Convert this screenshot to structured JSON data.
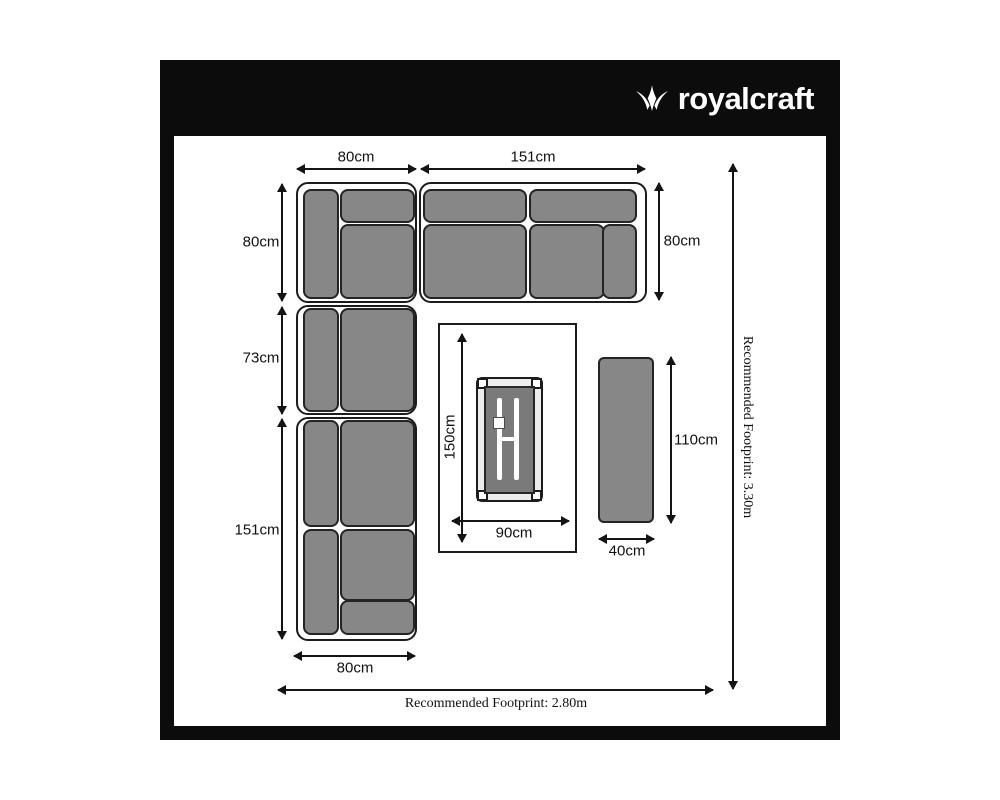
{
  "header": {
    "brand": "royalcraft"
  },
  "dimensions": {
    "corner_top_width": "80cm",
    "right_sofa_width": "151cm",
    "right_sofa_depth": "80cm",
    "corner_left_depth": "80cm",
    "left_mid_sofa_length": "73cm",
    "left_sofa_length": "151cm",
    "bottom_sofa_width": "80cm",
    "table_length": "150cm",
    "table_width": "90cm",
    "bench_length": "110cm",
    "bench_width": "40cm"
  },
  "footprints": {
    "bottom": "Recommended Footprint: 2.80m",
    "right": "Recommended Footprint: 3.30m"
  },
  "colors": {
    "frame_black": "#0c0c0c",
    "cushion_gray": "#878787",
    "table_top_gray": "#7a7a7a",
    "line_black": "#141414",
    "background": "#ffffff"
  }
}
